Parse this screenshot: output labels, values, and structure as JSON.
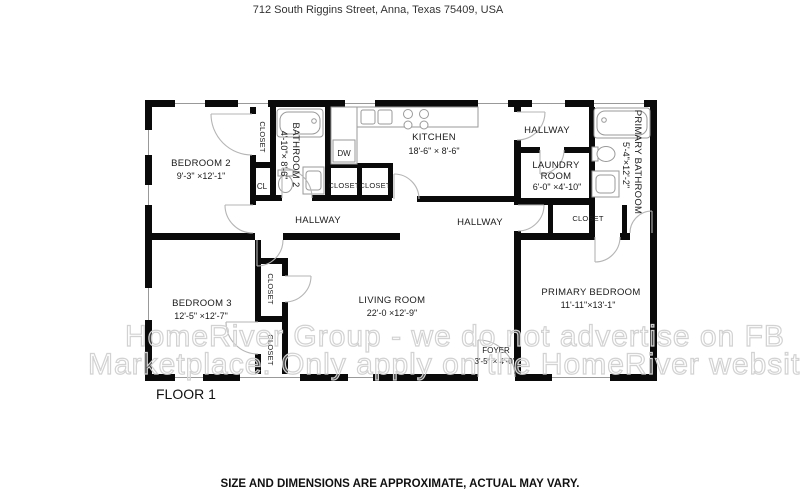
{
  "page": {
    "address": "712 South Riggins Street, Anna, Texas 75409, USA",
    "floor_label": "FLOOR 1",
    "disclaimer": "SIZE AND DIMENSIONS ARE APPROXIMATE, ACTUAL MAY VARY."
  },
  "watermark": {
    "line1": "HomeRiver Group - we do not advertise on FB",
    "line2": "Marketplace. Only apply on the HomeRiver website."
  },
  "rooms": {
    "bedroom2": {
      "name": "BEDROOM 2",
      "dims": "9'-3\" ×12'-1\""
    },
    "bathroom2": {
      "name": "BATHROOM 2",
      "dims": "4'-10\"× 8'-6\""
    },
    "kitchen": {
      "name": "KITCHEN",
      "dims": "18'-6\" × 8'-6\""
    },
    "laundry": {
      "name1": "LAUNDRY",
      "name2": "ROOM",
      "dims": "6'-0\" ×4'-10\""
    },
    "primary_bathroom": {
      "name": "PRIMARY BATHROOM",
      "dims": "5'-4\"×12'-2\""
    },
    "bedroom3": {
      "name": "BEDROOM 3",
      "dims": "12'-5\" ×12'-7\""
    },
    "living_room": {
      "name": "LIVING ROOM",
      "dims": "22'-0 ×12'-9\""
    },
    "foyer": {
      "name": "FOYER",
      "dims": "3'-5\" × 4'-0\""
    },
    "primary_bedroom": {
      "name": "PRIMARY BEDROOM",
      "dims": "11'-11\"×13'-1\""
    },
    "hallway1": {
      "name": "HALLWAY"
    },
    "hallway2": {
      "name": "HALLWAY"
    },
    "hallway3": {
      "name": "HALLWAY"
    }
  },
  "labels": {
    "closet": "CLOSET",
    "cl": "CL",
    "dw": "DW"
  },
  "colors": {
    "wall": "#0a0a0a",
    "fixture": "#9a9a9a",
    "door": "#b5b5b5",
    "text": "#1a1a1a",
    "watermark": "#d2d2d2"
  }
}
